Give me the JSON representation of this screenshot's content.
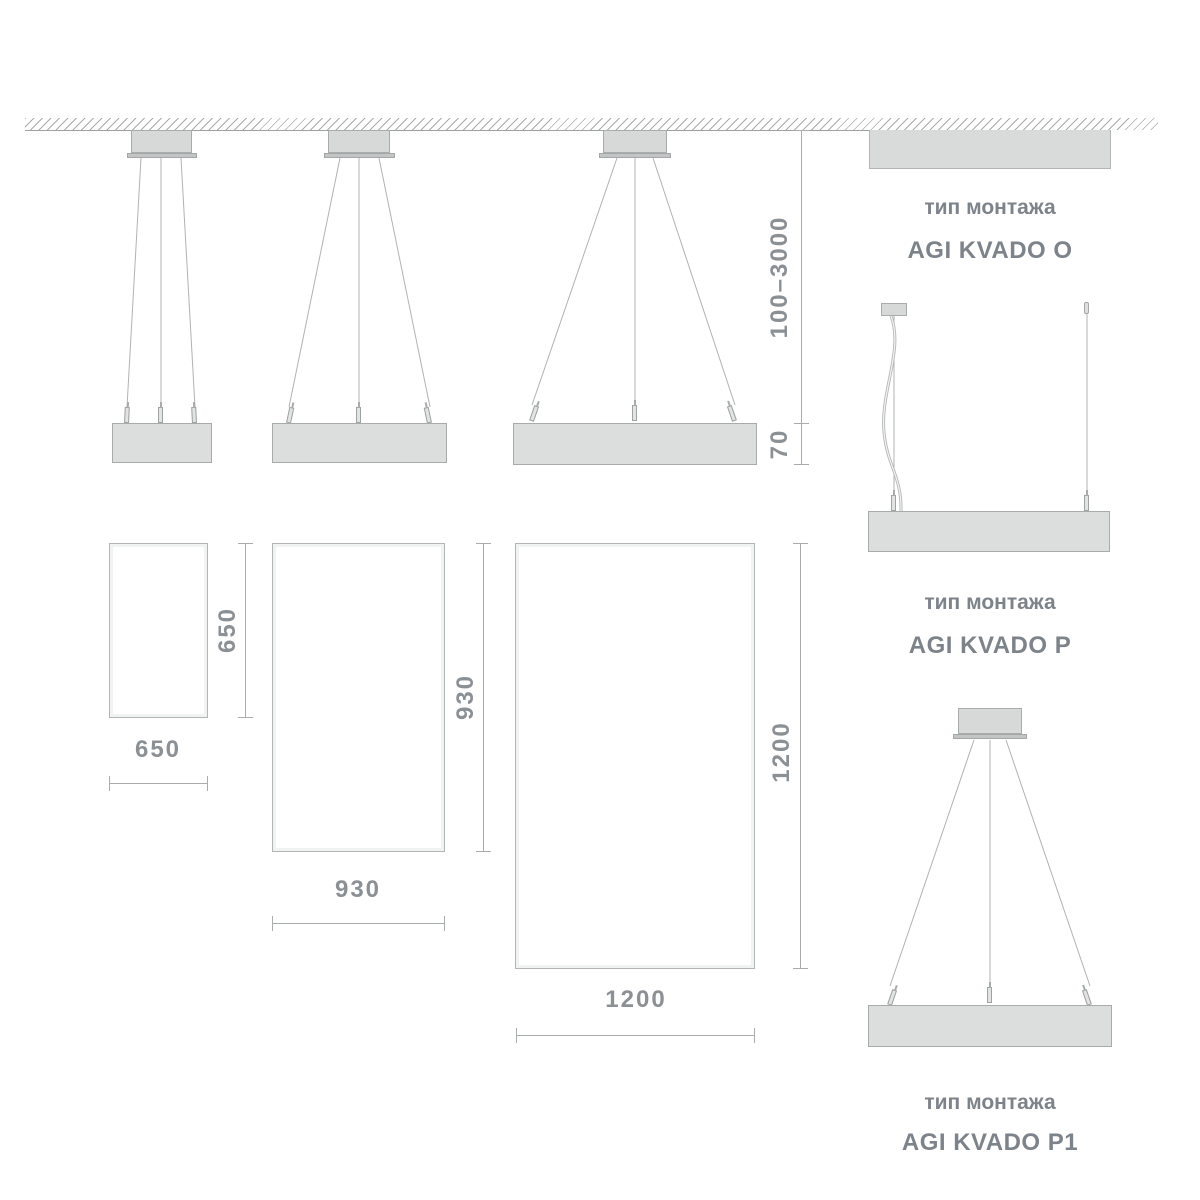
{
  "diagram": {
    "suspension_dim": {
      "range": "100–3000",
      "fixture_height": "70"
    },
    "panels": [
      {
        "width": "650",
        "height": "650"
      },
      {
        "width": "930",
        "height": "930"
      },
      {
        "width": "1200",
        "height": "1200"
      }
    ],
    "mounts": [
      {
        "caption": "тип монтажа",
        "model": "AGI KVADO O"
      },
      {
        "caption": "тип монтажа",
        "model": "AGI KVADO P"
      },
      {
        "caption": "тип монтажа",
        "model": "AGI KVADO P1"
      }
    ],
    "colors": {
      "fixture_fill": "#dcdddd",
      "edge": "#a8abab",
      "dim_line": "#a9acac",
      "dim_text": "#8b9095",
      "label_text": "#7d838a"
    }
  }
}
